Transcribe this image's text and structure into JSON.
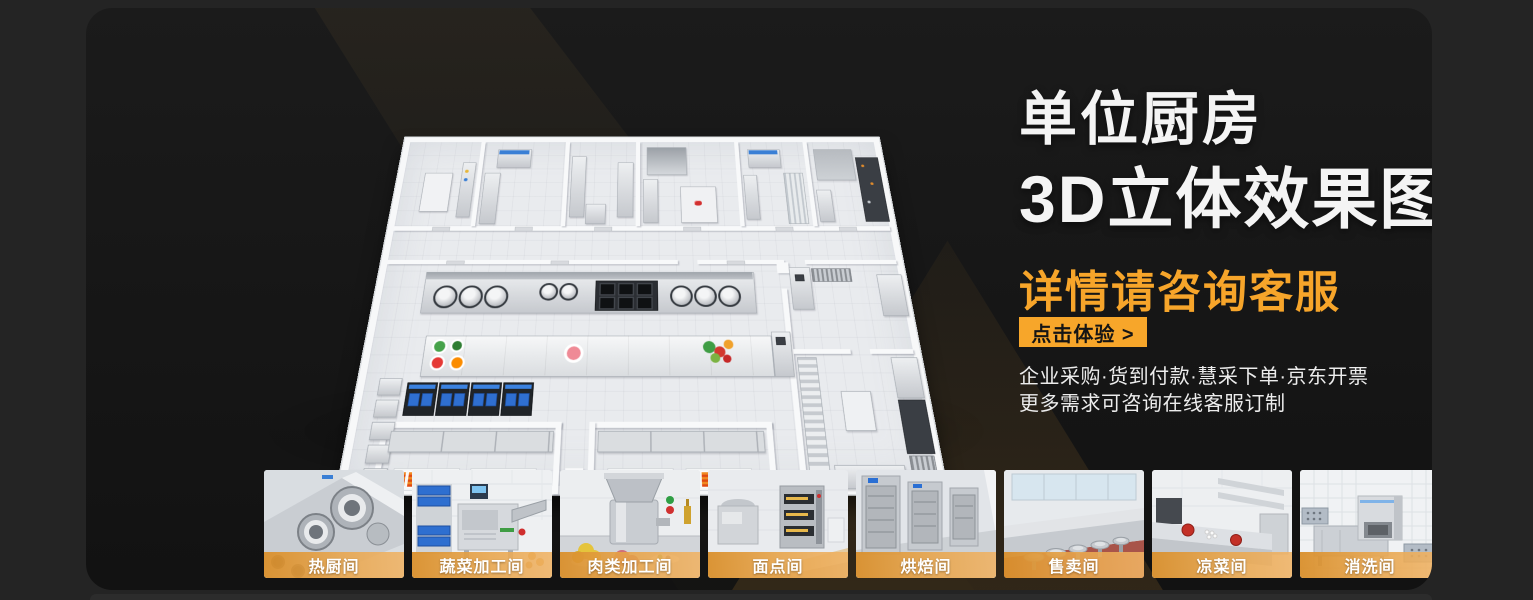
{
  "hero": {
    "title_line1": "单位厨房",
    "title_line2": "3D立体效果图",
    "subtitle": "详情请咨询客服",
    "cta_label": "点击体验 >",
    "info_line1": "企业采购·货到付款·慧采下单·京东开票",
    "info_line2": "更多需求可咨询在线客服订制"
  },
  "thumbnails": [
    {
      "label": "热厨间"
    },
    {
      "label": "蔬菜加工间"
    },
    {
      "label": "肉类加工间"
    },
    {
      "label": "面点间"
    },
    {
      "label": "烘焙间"
    },
    {
      "label": "售卖间"
    },
    {
      "label": "凉菜间"
    },
    {
      "label": "消洗间"
    }
  ],
  "colors": {
    "accent_orange": "#F7A62A",
    "outer_background": "#242424",
    "panel_background": "#161616",
    "title_white": "#F4F4F4"
  }
}
